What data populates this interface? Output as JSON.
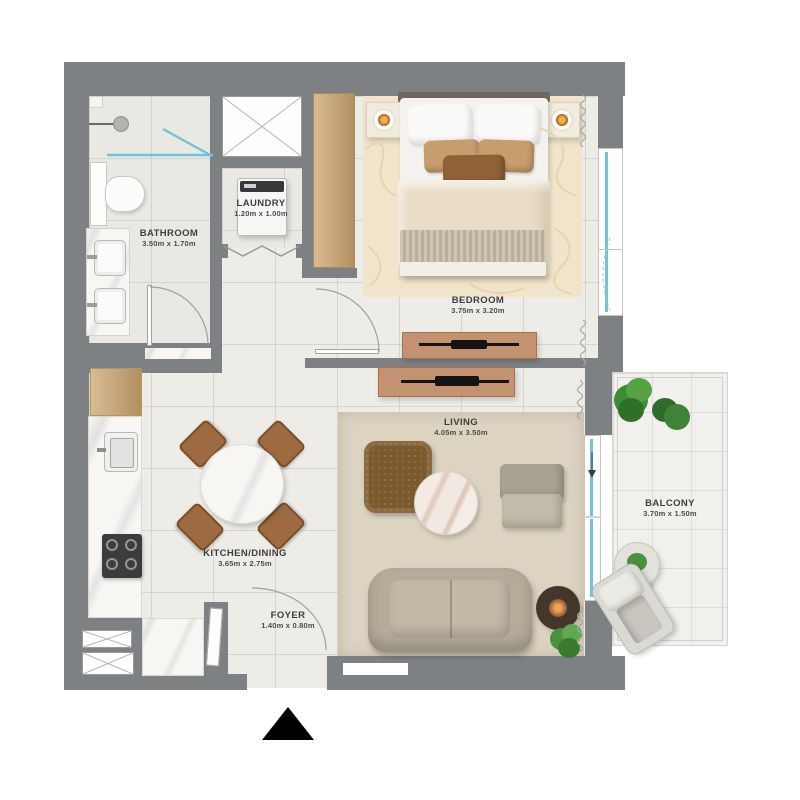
{
  "rooms": {
    "bathroom": {
      "label": "BATHROOM",
      "dims": "3.50m x 1.70m"
    },
    "laundry": {
      "label": "LAUNDRY",
      "dims": "1.20m x 1.00m"
    },
    "bedroom": {
      "label": "BEDROOM",
      "dims": "3.75m x 3.20m"
    },
    "kitchen_dining": {
      "label": "KITCHEN/DINING",
      "dims": "3.65m x 2.75m"
    },
    "living": {
      "label": "LIVING",
      "dims": "4.05m x 3.50m"
    },
    "foyer": {
      "label": "FOYER",
      "dims": "1.40m x 0.80m"
    },
    "balcony": {
      "label": "BALCONY",
      "dims": "3.70m x 1.50m"
    }
  },
  "colors": {
    "wall": "#7e8184",
    "floor": "#edece7",
    "wet_floor": "#e9e8e3",
    "glass": "#6fc3da",
    "wood": "#c5a379",
    "console_tan": "#c49270",
    "bedroom_rug": "#f1e4cb",
    "living_rug": "#dcd3c1",
    "plant_green": "#4c9140",
    "tv_black": "#141414",
    "label_text": "#3e3e3e"
  }
}
